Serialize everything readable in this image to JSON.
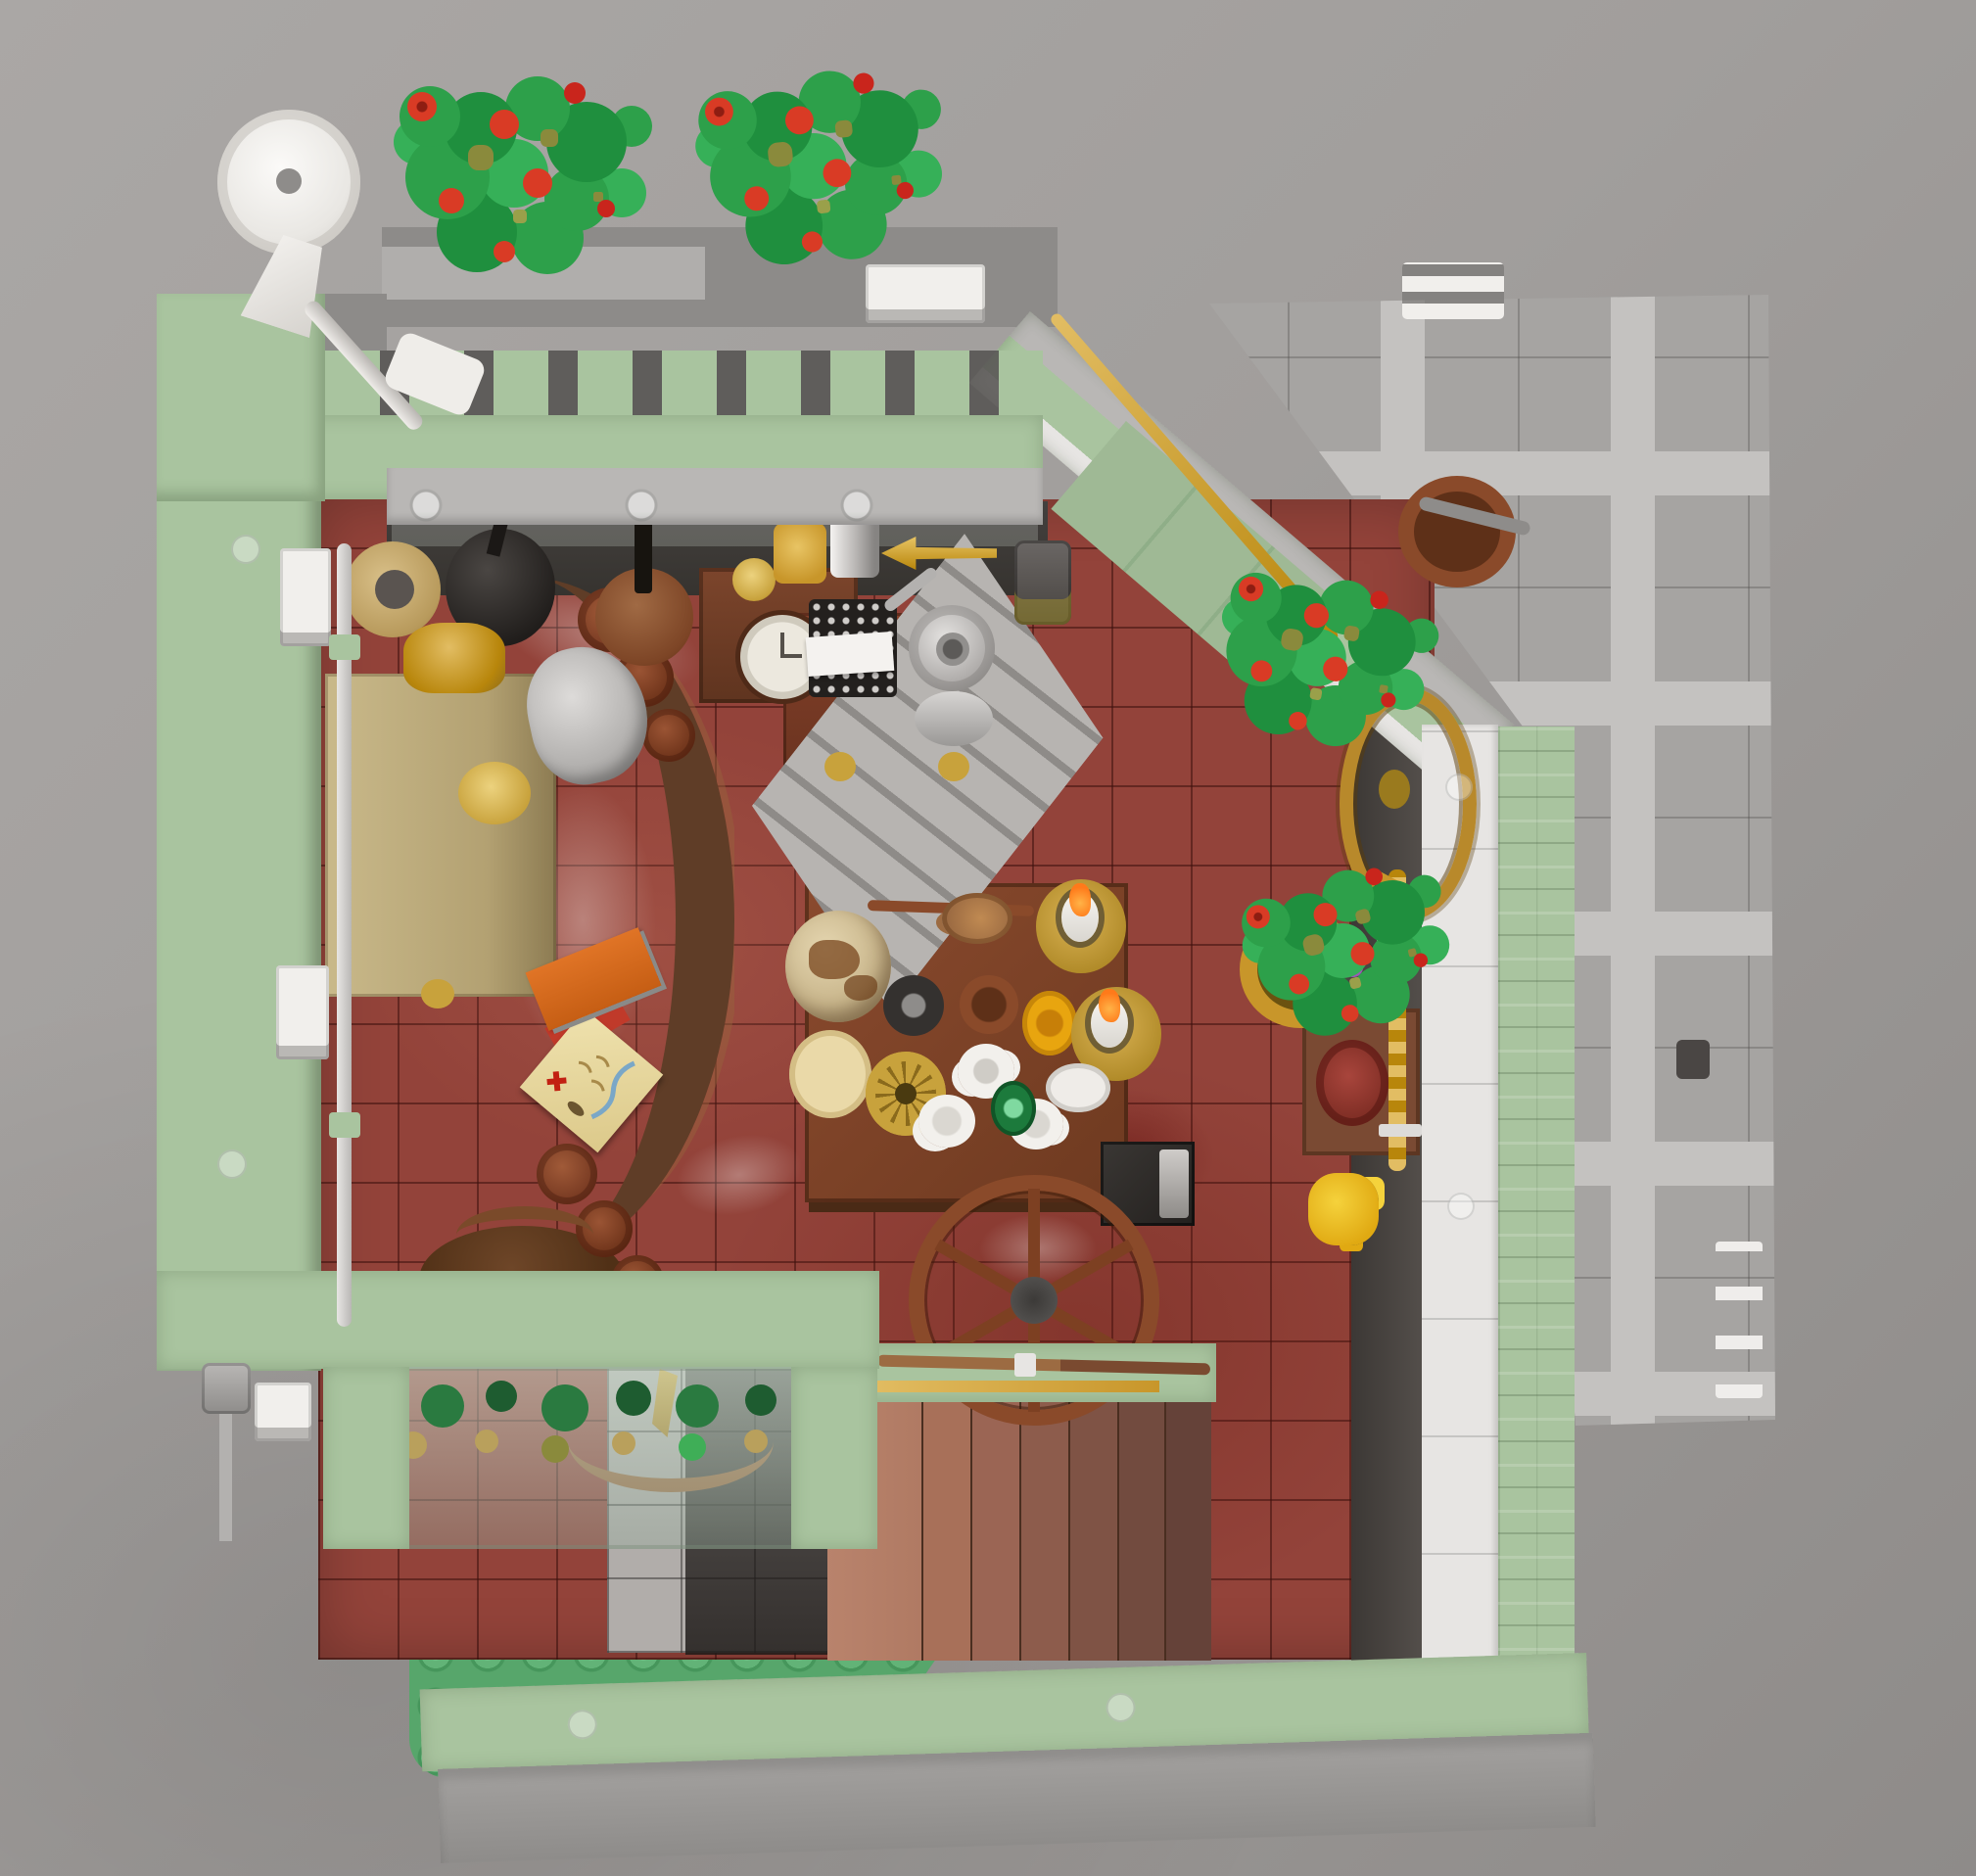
{
  "scene": {
    "description": "Top-down photograph of a LEGO modular building interior: a study/tavern room with dark red tile floor, sand-green crenellated walls, rose bushes on the parapet and sidewalk, a gray tiled sidewalk on the right, a green baseplate garden at lower left, a central wooden table set with candles, dishes and a globe, a writing desk with typewriter and meat grinder, a grandfather clock, a curved bar with bottles, a staircase, a wagon wheel and a white street lamp.",
    "objects": [
      {
        "name": "photo-backdrop",
        "color": "#a8a5a3"
      },
      {
        "name": "sidewalk-pavement",
        "color": "#a6a4a2"
      },
      {
        "name": "building-parapet",
        "color": "#a9c49f"
      },
      {
        "name": "street-lamp",
        "color": "#f1efec"
      },
      {
        "name": "rose-bush",
        "count": 4,
        "leaf": "#2da04a",
        "flower": "#d93b25"
      },
      {
        "name": "tile-floor",
        "color": "#93433a"
      },
      {
        "name": "writing-desk",
        "color": "#c9b98a"
      },
      {
        "name": "desk-lamp",
        "color": "#8a5a3c"
      },
      {
        "name": "gramophone",
        "color": "#2e2b29"
      },
      {
        "name": "stone-bust",
        "color": "#c9c7c5"
      },
      {
        "name": "grandfather-clock",
        "color": "#6e3a22"
      },
      {
        "name": "telescope",
        "color": "#d4a017"
      },
      {
        "name": "typewriter",
        "color": "#2e2b29"
      },
      {
        "name": "meat-grinder",
        "color": "#c9c7c5"
      },
      {
        "name": "corner-staircase",
        "color": "#b5b2b0"
      },
      {
        "name": "ships-wheel",
        "color": "#b8892b"
      },
      {
        "name": "bar-counter",
        "color": "#5e3a26"
      },
      {
        "name": "bottles",
        "color": "#7e3b2a"
      },
      {
        "name": "dining-table",
        "color": "#7c452c"
      },
      {
        "name": "globe",
        "color": "#c9b68c"
      },
      {
        "name": "candles",
        "count": 2,
        "flame": "#ff7a1a"
      },
      {
        "name": "treasure-map",
        "color": "#e8d89a"
      },
      {
        "name": "round-table",
        "color": "#5e3a22"
      },
      {
        "name": "stove-safe",
        "color": "#2e2b29"
      },
      {
        "name": "wall-lamp",
        "color": "#e0b84f"
      },
      {
        "name": "staircase",
        "color": "#b5806b"
      },
      {
        "name": "musket",
        "color": "#7a4a30"
      },
      {
        "name": "wagon-wheel",
        "color": "#8a4a2a"
      },
      {
        "name": "rope-sword",
        "color": "#c59a2f"
      },
      {
        "name": "trumpet",
        "color": "#b8860b"
      },
      {
        "name": "garden-baseplate",
        "color": "#57a66b"
      },
      {
        "name": "porch-garden",
        "color": "#1e5c30"
      }
    ]
  },
  "palette": {
    "backdrop1": "#aaa7a5",
    "backdrop2": "#8e8b89",
    "sidewalk-base": "#a6a4a2",
    "sidewalk-strip": "#c4c2c0",
    "sand": "#a9c49f",
    "sand-dark": "#92ad89",
    "sand-light": "#c0d5b8",
    "coping": "#b9b7b5",
    "walltop": "#8d8b89",
    "floor": "#93433a",
    "floor-grout": "#471410",
    "brown": "#7c4427",
    "brown-dark": "#5e3a22",
    "redbrown": "#8a4a2a",
    "tan": "#c9b98a",
    "gold": "#c8a23c",
    "gold-deep": "#b8860b",
    "white-piece": "#f1efec",
    "silver": "#c9c7c5",
    "black-piece": "#2e2b29",
    "leaf": "#2da04a",
    "leaf-dark": "#1f8f3e",
    "flower": "#d93b25",
    "plate-green": "#57a66b",
    "stud-green": "#62b377",
    "candle-flame": "#ff7a1a",
    "glass-green": "#1c7a3c",
    "map": "#e8d89a"
  }
}
